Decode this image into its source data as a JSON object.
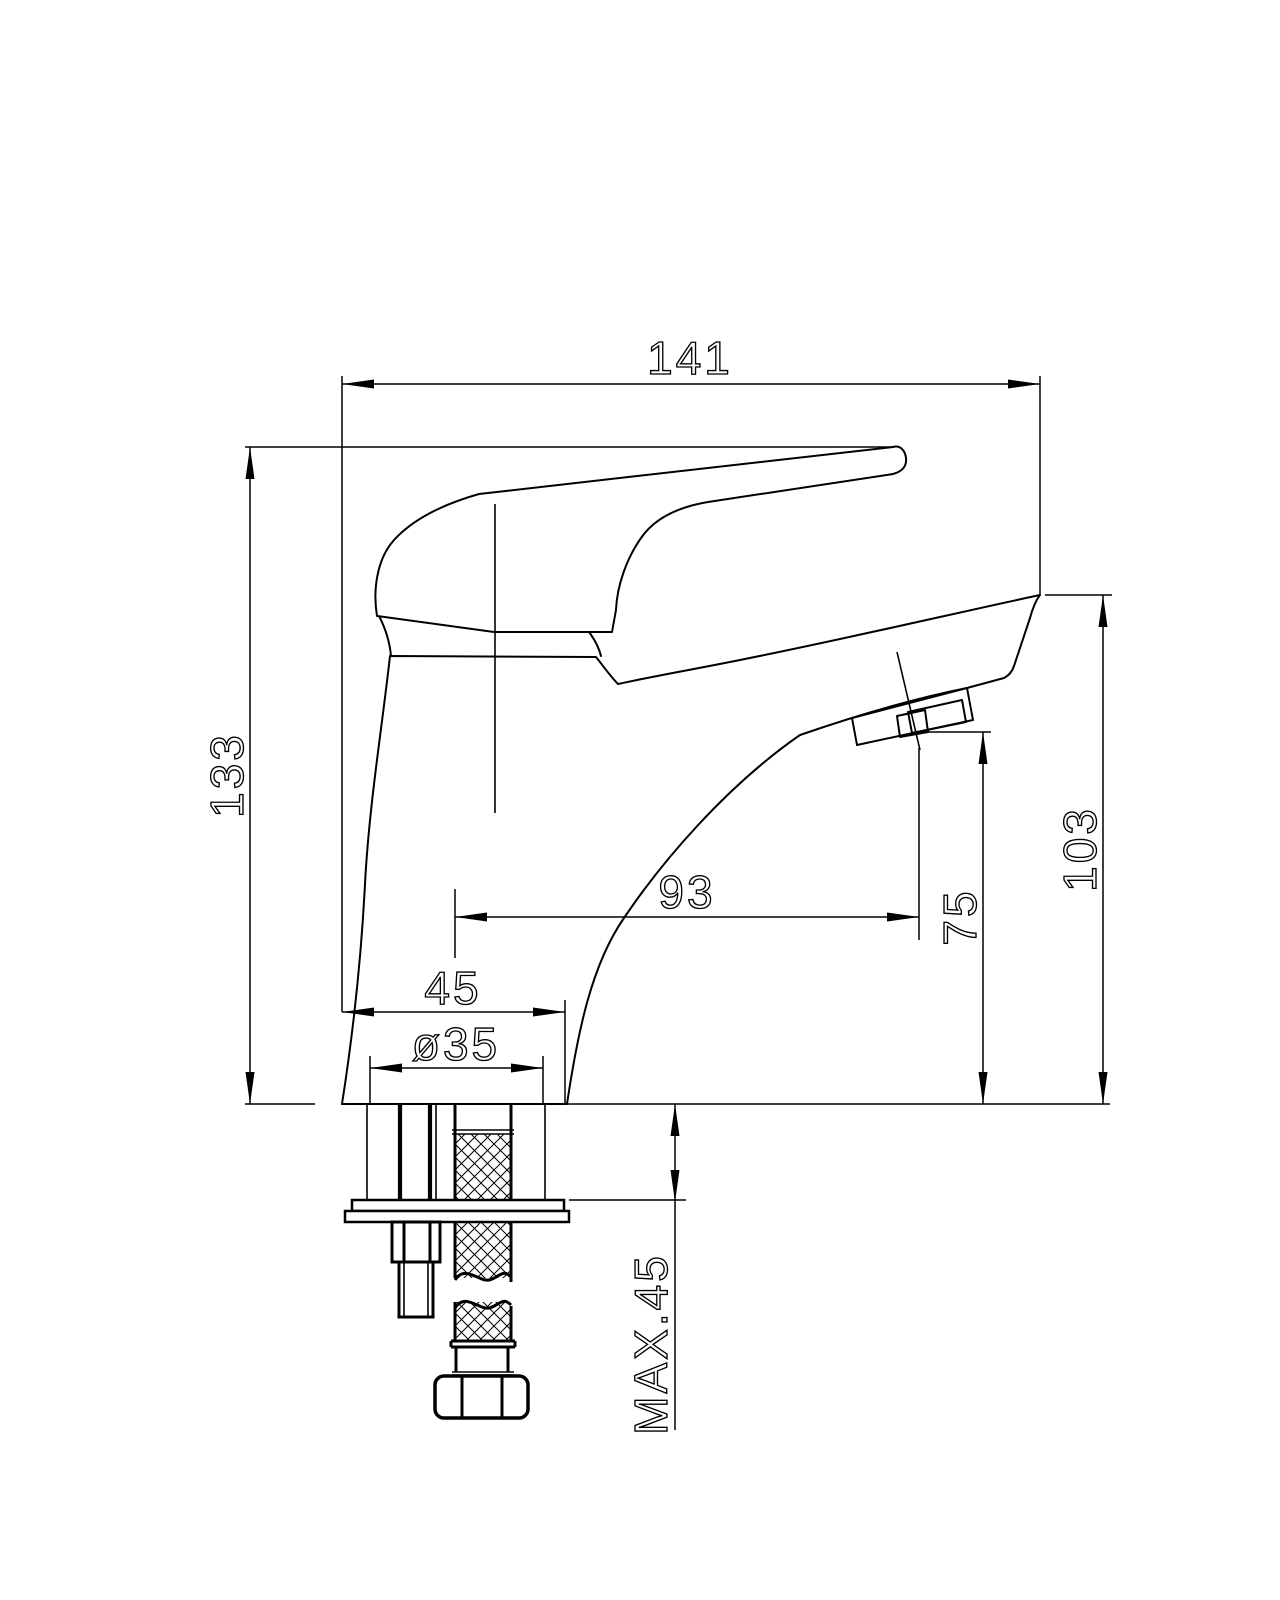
{
  "drawing": {
    "type": "faucet-installation-dimension-drawing",
    "background_color": "#ffffff",
    "line_color": "#000000",
    "dimensions": {
      "total_width": "141",
      "total_height": "133",
      "spout_tip_height": "103",
      "outlet_height": "75",
      "spout_reach": "93",
      "base_depth": "45",
      "mounting_hole_diameter": "ø35",
      "max_mounting_thickness": "MAX.45"
    }
  }
}
